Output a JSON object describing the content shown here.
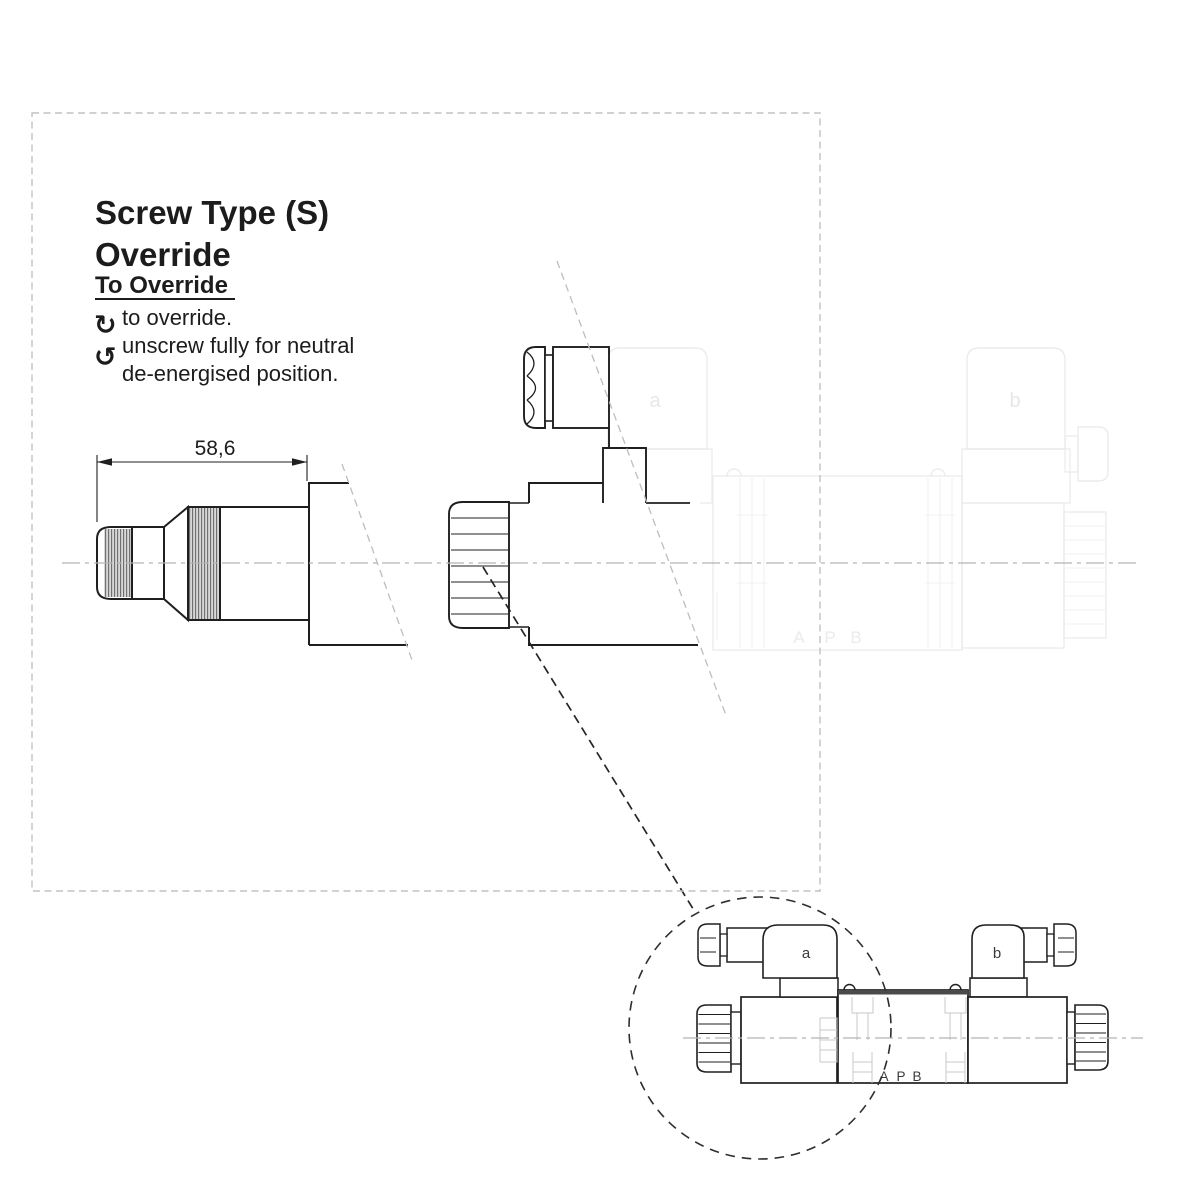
{
  "heading": {
    "line1": "Screw Type (S)",
    "line2": "Override",
    "subtitle": "To Override"
  },
  "instructions": {
    "cw_icon": "↻",
    "ccw_icon": "↺",
    "step1": "to override.",
    "step2_line1": "unscrew fully for neutral",
    "step2_line2": "de-energised position."
  },
  "dimension": {
    "length": "58,6"
  },
  "ghost_valve": {
    "solenoid_a": "a",
    "solenoid_b": "b",
    "port_a": "A",
    "port_p": "P",
    "port_b": "B"
  },
  "detail_view": {
    "solenoid_a": "a",
    "solenoid_b": "b",
    "port_a": "A",
    "port_p": "P",
    "port_b": "B"
  },
  "colors": {
    "ink": "#1f1f1f",
    "ghost": "#ececec",
    "centerline": "#b3b3b3",
    "frame": "#c2c2c2",
    "hatch_fill": "#d8d8d8",
    "hatch_line": "#707070",
    "hidden_detail": "#c9c9c9"
  }
}
